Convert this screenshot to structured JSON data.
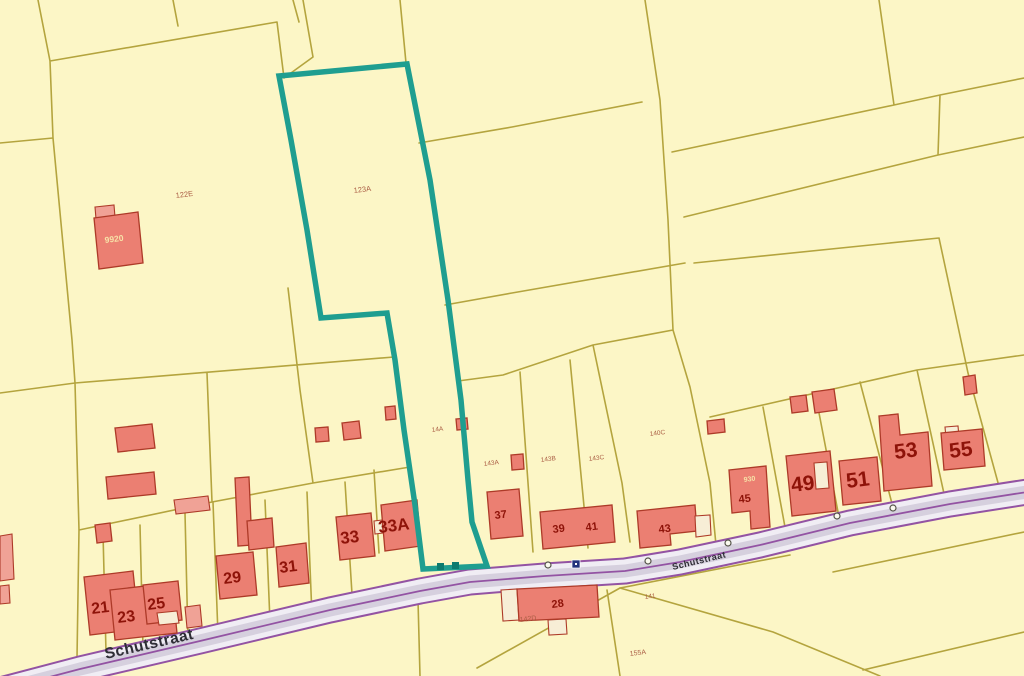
{
  "map": {
    "title": "Cadastral parcel map",
    "street": {
      "name": "Schutstraat"
    },
    "selected_parcel": {
      "upper_label": "123A",
      "lower_label": "14A",
      "outline_color": "#1f9e90"
    },
    "parcel_labels": {
      "p122e": "122E",
      "p123a": "123A",
      "p14a": "14A",
      "p143a": "143A",
      "p143b": "143B",
      "p143c": "143C",
      "p140c": "140C",
      "p141": "141",
      "p142d": "142D",
      "p155a": "155A"
    },
    "house_numbers": {
      "h21": "21",
      "h23": "23",
      "h25": "25",
      "h29": "29",
      "h31": "31",
      "h33": "33",
      "h33a": "33A",
      "h37": "37",
      "h39": "39",
      "h41": "41",
      "h43": "43",
      "h45": "45",
      "h49": "49",
      "h51": "51",
      "h53": "53",
      "h55": "55",
      "h28": "28"
    },
    "building_annotations": {
      "a9920": "9920",
      "a930": "930"
    },
    "colors": {
      "background": "#fcf6c6",
      "parcel_line": "#b4a43e",
      "building_fill": "#eb7f72",
      "building_stroke": "#ad3a28",
      "highlight": "#1f9e90",
      "road_edge": "#9353a3",
      "road_fill": "#f0edf4",
      "road_center": "#d6d0de",
      "house_number": "#8e1309",
      "parcel_label": "#ab5e45"
    }
  }
}
